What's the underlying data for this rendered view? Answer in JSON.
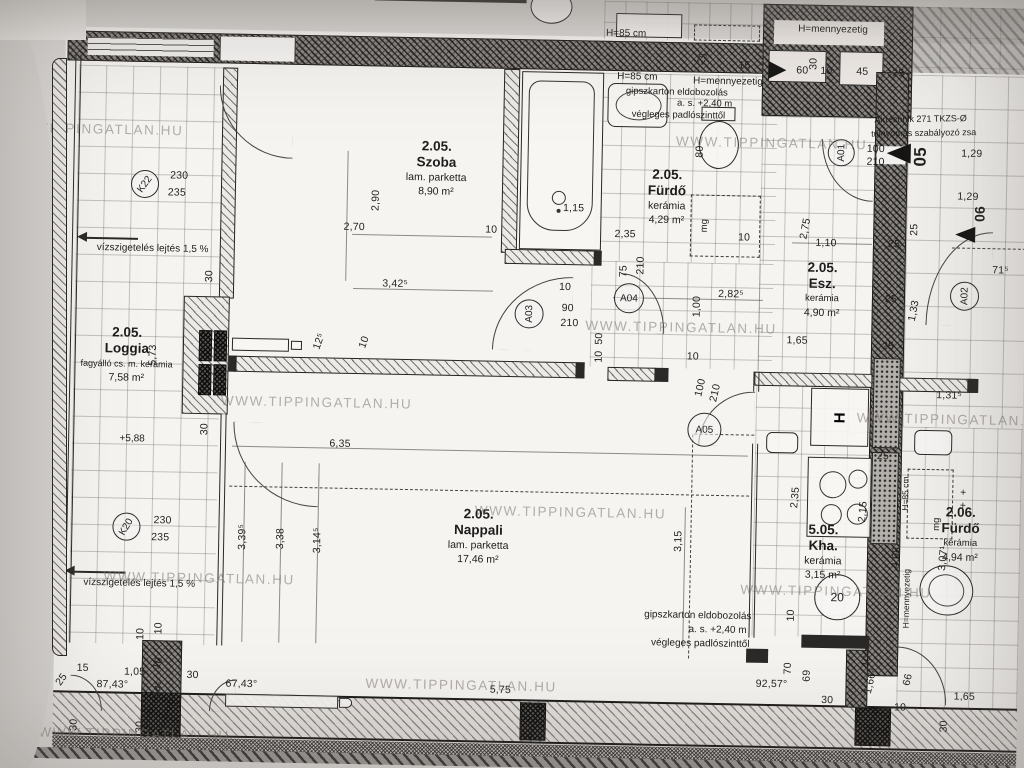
{
  "watermark": {
    "text": "WWW.TIPPINGATLAN.HU",
    "spots": [
      {
        "x": -12,
        "y": 138
      },
      {
        "x": 672,
        "y": 139
      },
      {
        "x": -150,
        "y": 318
      },
      {
        "x": 585,
        "y": 325
      },
      {
        "x": 222,
        "y": 407
      },
      {
        "x": 858,
        "y": 412
      },
      {
        "x": 478,
        "y": 512
      },
      {
        "x": 108,
        "y": 585
      },
      {
        "x": 745,
        "y": 586
      },
      {
        "x": 372,
        "y": 687
      },
      {
        "x": 46,
        "y": 742
      }
    ]
  },
  "rooms": {
    "szoba": {
      "number": "2.05.",
      "name": "Szoba",
      "finish": "lam. parketta",
      "area": "8,90 m²"
    },
    "furdo": {
      "number": "2.05.",
      "name": "Fürdő",
      "finish": "kerámia",
      "area": "4,29 m²"
    },
    "esz": {
      "number": "2.05.",
      "name": "Esz.",
      "finish": "kerámia",
      "area": "4,90 m²"
    },
    "loggia": {
      "number": "2.05.",
      "name": "Loggia",
      "finish": "fagyálló cs. m. kerámia",
      "area": "7,58 m²"
    },
    "nappali": {
      "number": "2.05.",
      "name": "Nappali",
      "finish": "lam. parketta",
      "area": "17,46 m²"
    },
    "kha": {
      "number": "5.05.",
      "name": "Kha.",
      "finish": "kerámia",
      "area": "3,15 m²"
    },
    "furdo206": {
      "number": "2.06.",
      "name": "Fürdő",
      "finish": "kerámia",
      "area": "4,94 m²"
    }
  },
  "notes": {
    "waterproof_top": "vízszigetelés lejtés 1,5 %",
    "waterproof_bottom": "vízszigetelés lejtés 1,5 %",
    "h85_top": "H=85 cm",
    "h85_mid": "H=85 cm",
    "h_ceiling_mid": "H=mennyezetig",
    "h_ceiling_tr": "H=mennyezetig",
    "h85_vert": "H=85 cm",
    "h_ceiling_vert": "H=mennyezetig",
    "gipsz_l1": "gipszkarton eldobozolás",
    "gipsz_l2": "a. s. +2,40 m",
    "gipsz_l3": "végleges padlószinttől",
    "airtech_l1": "Airtechnik 271 TKZS-Ø",
    "airtech_l2": "túlnyomás szabályozó zsa",
    "level": "+5,88"
  },
  "markers": {
    "k22": "K22",
    "k20": "K20",
    "a01": "A01",
    "a02": "A02",
    "a03": "A03",
    "a04": "A04",
    "a05": "A05",
    "boiler": "20",
    "fridge": "H",
    "washer": "mg"
  },
  "dims": [
    {
      "t": "15",
      "x": 739,
      "y": 62
    },
    {
      "t": "25",
      "x": 697,
      "y": 56,
      "r": -70
    },
    {
      "t": "60",
      "x": 797,
      "y": 66
    },
    {
      "t": "30",
      "x": 808,
      "y": 59,
      "r": -90
    },
    {
      "t": "10",
      "x": 821,
      "y": 66
    },
    {
      "t": "45",
      "x": 857,
      "y": 66
    },
    {
      "t": "25",
      "x": 893,
      "y": 67
    },
    {
      "t": "100",
      "x": 872,
      "y": 143
    },
    {
      "t": "210",
      "x": 872,
      "y": 156
    },
    {
      "t": "05",
      "x": 917,
      "y": 150,
      "r": -90,
      "s": 17,
      "b": 1
    },
    {
      "t": "1,29",
      "x": 968,
      "y": 146
    },
    {
      "t": "1,29",
      "x": 965,
      "y": 189
    },
    {
      "t": "06",
      "x": 977,
      "y": 206,
      "r": -90,
      "s": 14,
      "b": 1
    },
    {
      "t": "71⁵",
      "x": 999,
      "y": 262
    },
    {
      "t": "2,90",
      "x": 373,
      "y": 204,
      "r": -90
    },
    {
      "t": "2,70",
      "x": 352,
      "y": 231
    },
    {
      "t": "3,42⁵",
      "x": 394,
      "y": 287
    },
    {
      "t": "10",
      "x": 489,
      "y": 231
    },
    {
      "t": "1,15",
      "x": 571,
      "y": 208
    },
    {
      "t": "10",
      "x": 564,
      "y": 287
    },
    {
      "t": "80",
      "x": 696,
      "y": 149,
      "r": -90
    },
    {
      "t": "2,35",
      "x": 623,
      "y": 233
    },
    {
      "t": "10",
      "x": 742,
      "y": 234
    },
    {
      "t": "75",
      "x": 622,
      "y": 270,
      "r": -90
    },
    {
      "t": "210",
      "x": 639,
      "y": 264,
      "r": -90
    },
    {
      "t": "90",
      "x": 567,
      "y": 308
    },
    {
      "t": "210",
      "x": 569,
      "y": 323
    },
    {
      "t": "50",
      "x": 599,
      "y": 338,
      "r": -90
    },
    {
      "t": "10",
      "x": 599,
      "y": 356,
      "r": -90
    },
    {
      "t": "2,82⁵",
      "x": 730,
      "y": 291
    },
    {
      "t": "1,00",
      "x": 696,
      "y": 304,
      "r": -90
    },
    {
      "t": "10",
      "x": 693,
      "y": 354
    },
    {
      "t": "100",
      "x": 701,
      "y": 385,
      "r": -78
    },
    {
      "t": "210",
      "x": 716,
      "y": 390,
      "r": -78
    },
    {
      "t": "2,75",
      "x": 803,
      "y": 224,
      "r": -80
    },
    {
      "t": "1,10",
      "x": 824,
      "y": 238
    },
    {
      "t": "25",
      "x": 892,
      "y": 238
    },
    {
      "t": "25",
      "x": 912,
      "y": 223,
      "r": -90
    },
    {
      "t": "25",
      "x": 890,
      "y": 293
    },
    {
      "t": "25",
      "x": 888,
      "y": 340
    },
    {
      "t": "1,65",
      "x": 797,
      "y": 336
    },
    {
      "t": "1,33",
      "x": 913,
      "y": 304,
      "r": -80
    },
    {
      "t": "1,31⁵",
      "x": 950,
      "y": 388
    },
    {
      "t": "230",
      "x": 176,
      "y": 183
    },
    {
      "t": "235",
      "x": 174,
      "y": 200
    },
    {
      "t": "230",
      "x": 166,
      "y": 528
    },
    {
      "t": "235",
      "x": 164,
      "y": 545
    },
    {
      "t": "30",
      "x": 208,
      "y": 283,
      "r": -90
    },
    {
      "t": "5,73",
      "x": 153,
      "y": 363,
      "r": -90
    },
    {
      "t": "30",
      "x": 206,
      "y": 436,
      "r": -90
    },
    {
      "t": "10",
      "x": 164,
      "y": 636,
      "r": -90
    },
    {
      "t": "12⁵",
      "x": 319,
      "y": 346,
      "r": -72
    },
    {
      "t": "10",
      "x": 364,
      "y": 346,
      "r": -72
    },
    {
      "t": "6,35",
      "x": 342,
      "y": 448
    },
    {
      "t": "3,39⁵",
      "x": 246,
      "y": 543,
      "r": -90
    },
    {
      "t": "3,38",
      "x": 284,
      "y": 544,
      "r": -90
    },
    {
      "t": "3,14⁵",
      "x": 321,
      "y": 545,
      "r": -90
    },
    {
      "t": "3,15",
      "x": 682,
      "y": 539,
      "r": -90
    },
    {
      "t": "25",
      "x": 885,
      "y": 450
    },
    {
      "t": "2,35",
      "x": 798,
      "y": 493,
      "r": -86
    },
    {
      "t": "2,15",
      "x": 866,
      "y": 506,
      "r": -86
    },
    {
      "t": "4,08",
      "x": 900,
      "y": 551,
      "r": -86
    },
    {
      "t": "3,07¹",
      "x": 947,
      "y": 551,
      "r": -86
    },
    {
      "t": "+",
      "x": 966,
      "y": 485
    },
    {
      "t": "+",
      "x": 966,
      "y": 498
    },
    {
      "t": "92,57°",
      "x": 778,
      "y": 680
    },
    {
      "t": "10",
      "x": 796,
      "y": 611,
      "r": -90
    },
    {
      "t": "70",
      "x": 794,
      "y": 664,
      "r": -90
    },
    {
      "t": "69",
      "x": 813,
      "y": 671,
      "r": -90
    },
    {
      "t": "10⁵",
      "x": 873,
      "y": 653,
      "r": -78
    },
    {
      "t": "1,66⁵",
      "x": 877,
      "y": 675,
      "r": -78
    },
    {
      "t": "66",
      "x": 914,
      "y": 673,
      "r": -78
    },
    {
      "t": "30",
      "x": 834,
      "y": 695
    },
    {
      "t": "10",
      "x": 907,
      "y": 701
    },
    {
      "t": "1,65",
      "x": 971,
      "y": 689
    },
    {
      "t": "30",
      "x": 951,
      "y": 719,
      "r": -90
    },
    {
      "t": "15",
      "x": 36,
      "y": 674
    },
    {
      "t": "15",
      "x": 89,
      "y": 677
    },
    {
      "t": "1,05",
      "x": 141,
      "y": 680
    },
    {
      "t": "10",
      "x": 164,
      "y": 671,
      "r": -72
    },
    {
      "t": "87,43°",
      "x": 119,
      "y": 693
    },
    {
      "t": "54⁵",
      "x": 165,
      "y": 697,
      "r": -72
    },
    {
      "t": "25",
      "x": 68,
      "y": 689,
      "r": -55
    },
    {
      "t": "30",
      "x": 81,
      "y": 734,
      "r": -90
    },
    {
      "t": "30",
      "x": 147,
      "y": 735,
      "r": -90
    },
    {
      "t": "30",
      "x": 199,
      "y": 682
    },
    {
      "t": "67,43°",
      "x": 248,
      "y": 690
    },
    {
      "t": "5,75",
      "x": 507,
      "y": 691
    },
    {
      "t": "10",
      "x": 69,
      "y": 638,
      "r": -90
    },
    {
      "t": "10",
      "x": 146,
      "y": 642,
      "r": -90
    }
  ]
}
